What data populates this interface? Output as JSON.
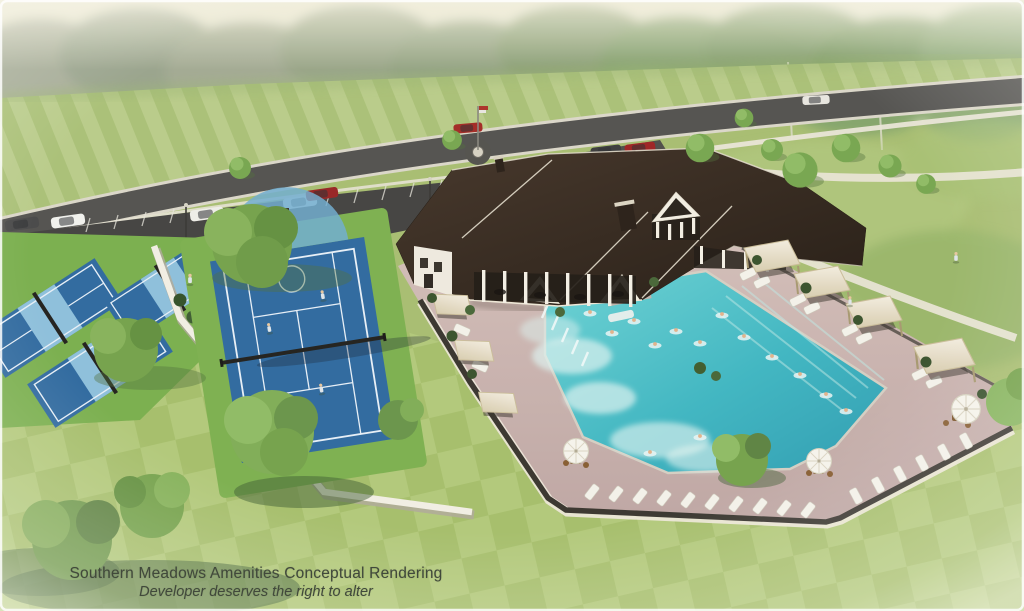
{
  "image": {
    "kind": "aerial-architectural-conceptual-rendering",
    "caption": {
      "line1": "Southern Meadows Amenities Conceptual Rendering",
      "line2": "Developer deserves the right to alter"
    }
  },
  "scene": {
    "amenities": [
      "clubhouse",
      "resort-pool",
      "splash-zone",
      "lap-lanes",
      "tennis-basketball-court",
      "pickleball-courts",
      "playground",
      "cabanas",
      "lounge-deck",
      "umbrella-seating",
      "parking-lot",
      "entry-drive",
      "flagpole-roundabout",
      "walking-paths",
      "event-lawn",
      "tree-line"
    ]
  },
  "colors": {
    "sky_haze": "#e9e7d2",
    "far_trees": "#9fa98f",
    "field_green": "#aac274",
    "field_stripe": "#b9cd87",
    "lawn_checker_a": "#a6c068",
    "lawn_checker_b": "#b2ca77",
    "road_asphalt": "#545350",
    "parking_asphalt": "#454441",
    "court_blue": "#2e6ba3",
    "court_light_blue": "#8cc0de",
    "court_green": "#7cb24c",
    "roof_brown": "#342820",
    "wall_cream": "#f1ecdc",
    "pool_water": "#3fbfc4",
    "deck_mauve": "#c9b2ae",
    "canopy_cream": "#eee6d2",
    "fence_dark": "#3a362f",
    "caption_text": "#41493b"
  }
}
